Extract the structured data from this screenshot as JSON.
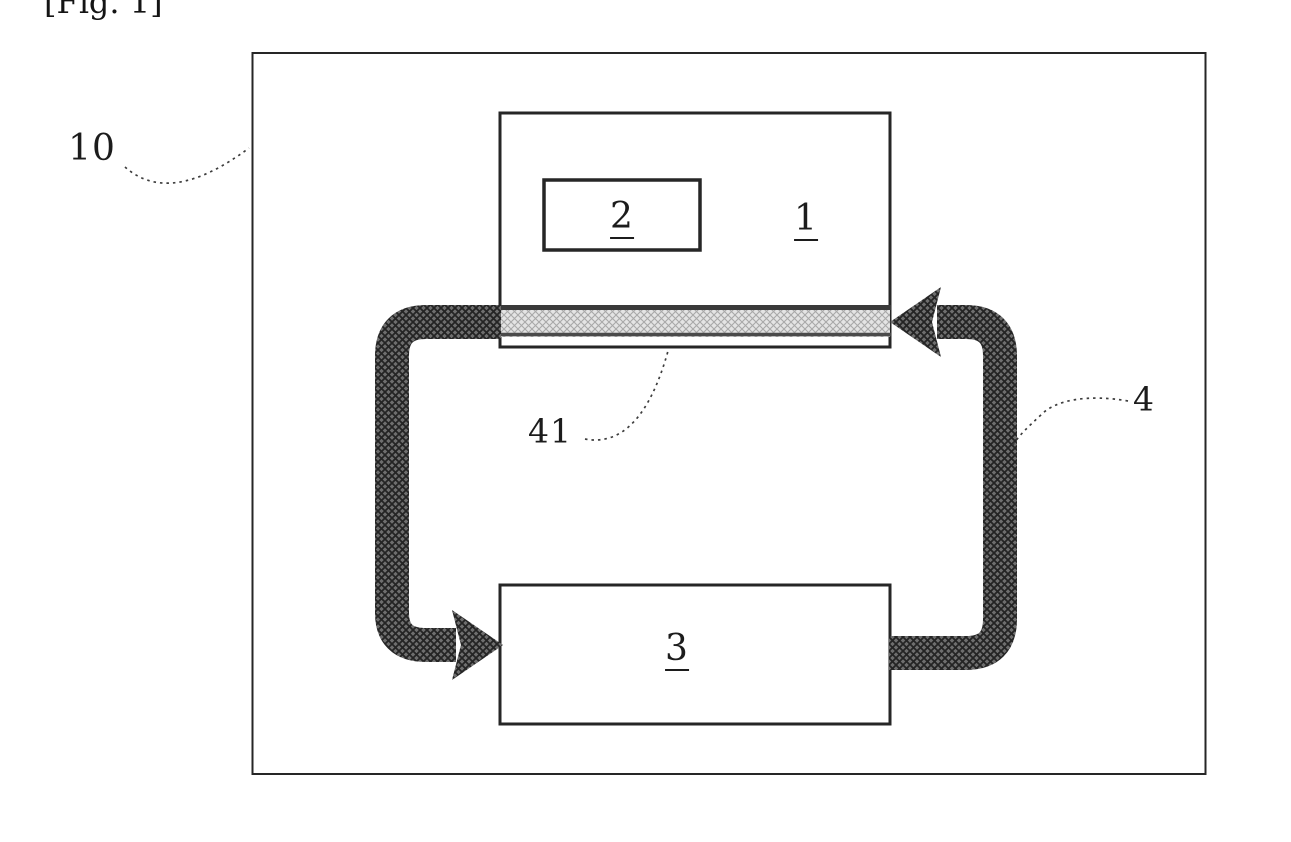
{
  "figure": {
    "caption": "[Fig. 1]"
  },
  "labels": {
    "system": "10",
    "unit1": "1",
    "unit2": "2",
    "unit3": "3",
    "strip": "41",
    "loop": "4"
  },
  "icons": {
    "loop_arrowhead_left": "arrowhead-pointing-left",
    "loop_arrowhead_right": "arrowhead-pointing-right"
  },
  "colors": {
    "ink": "#1c1c1c",
    "border": "#262626",
    "band_base": "#6e6e6e",
    "band_hatch": "#242424",
    "strip_base": "#e4e4e4",
    "strip_hatch": "#a8a8a8",
    "leader": "#3d3d3d",
    "background": "#ffffff"
  }
}
